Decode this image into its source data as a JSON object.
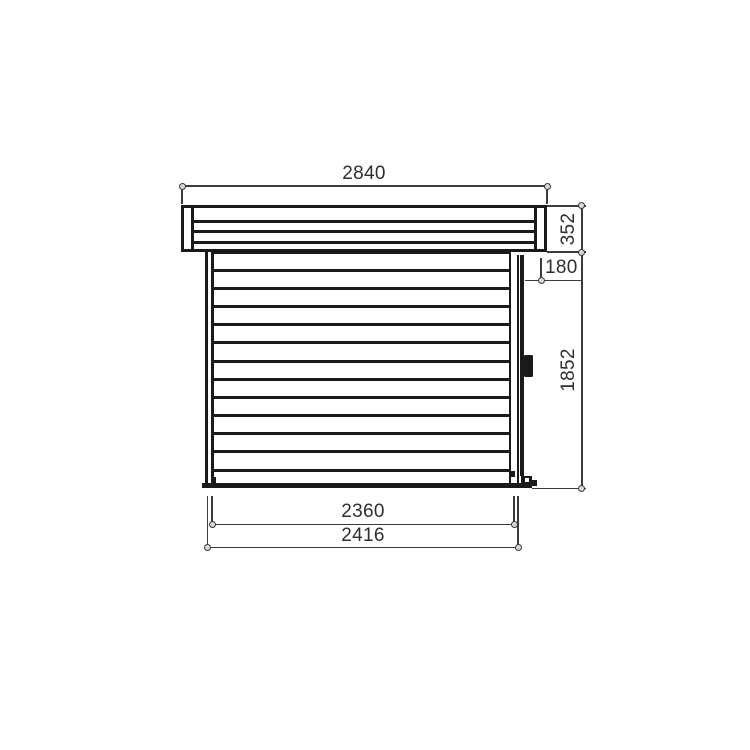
{
  "drawing": {
    "type": "shed-side-elevation-technical-drawing",
    "dimensions": {
      "roof_width_mm": "2840",
      "roof_height_mm": "352",
      "top_log_offset_mm": "180",
      "wall_height_mm": "1852",
      "wall_inner_width_mm": "2360",
      "wall_outer_width_mm": "2416"
    },
    "colors": {
      "background": "#ffffff",
      "building_line": "#1a1a1a",
      "dimension_line": "#3b3b3b",
      "label_text": "#2f2f2f"
    }
  }
}
